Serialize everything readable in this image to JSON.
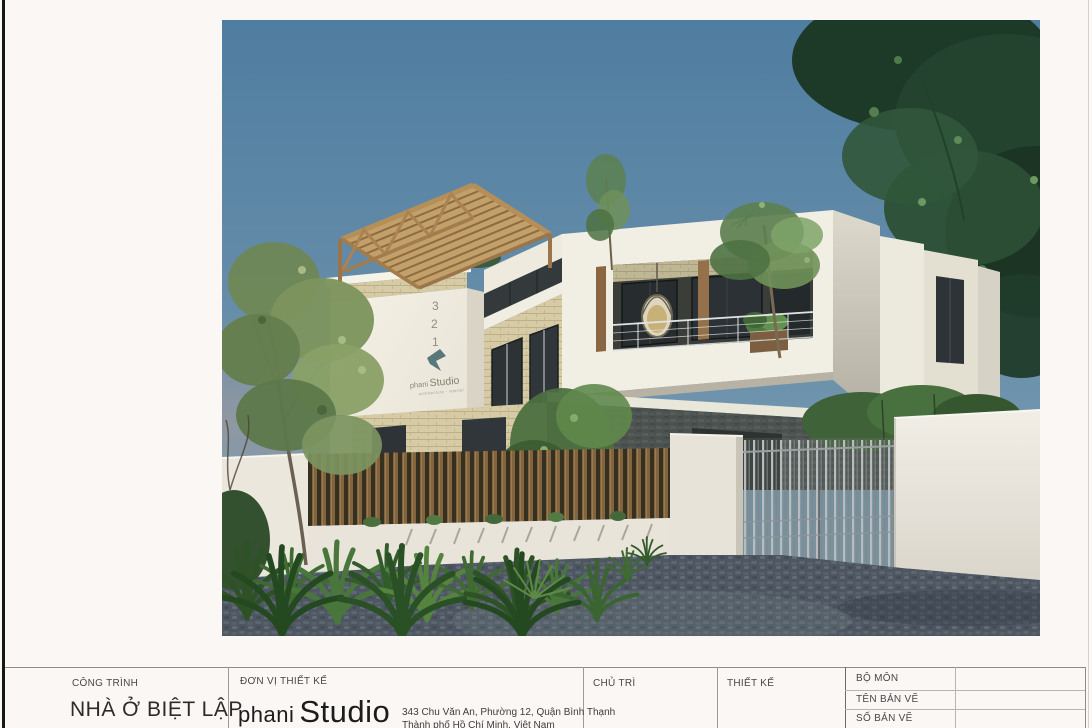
{
  "sheet": {
    "background": "#fbf7f5",
    "border_color": "#161616"
  },
  "rendering": {
    "description": "3D exterior rendering of a modern two-storey detached house with rooftop timber pergola, cantilevered balcony, wooden slat fence, vertical-bar gate and cobblestone driveway under a blue sky",
    "colors": {
      "sky": "#567f9e",
      "pergola_wood": "#b68e58",
      "house_white": "#f1eee3",
      "brick_cream": "#d6cba4",
      "stone_dark": "#4b524f",
      "fence_wood": "#82643f",
      "driveway": "#4e5761",
      "foliage_dark": "#24432e",
      "foliage_light": "#7d945e"
    },
    "wall_sign": {
      "digits": [
        "3",
        "2",
        "1"
      ],
      "brand_first": "phani",
      "brand_second": "Studio",
      "tagline": "architecture - interior"
    }
  },
  "title_block": {
    "project": {
      "label": "CÔNG TRÌNH",
      "value": "NHÀ Ở BIỆT LẬP"
    },
    "design_firm": {
      "label": "ĐƠN VỊ THIẾT KẾ",
      "brand_first": "phani",
      "brand_second": "Studio",
      "address_line1": "343 Chu Văn An, Phường 12, Quận Bình Thạnh",
      "address_line2": "Thành phố Hồ Chí Minh, Việt Nam"
    },
    "lead": {
      "label": "CHỦ TRÌ",
      "value": ""
    },
    "designer": {
      "label": "THIẾT KẾ",
      "value": ""
    },
    "info_rows": [
      {
        "label": "BỘ MÔN",
        "value": ""
      },
      {
        "label": "TÊN BẢN VẼ",
        "value": ""
      },
      {
        "label": "SỐ BẢN VẼ",
        "value": ""
      }
    ]
  }
}
